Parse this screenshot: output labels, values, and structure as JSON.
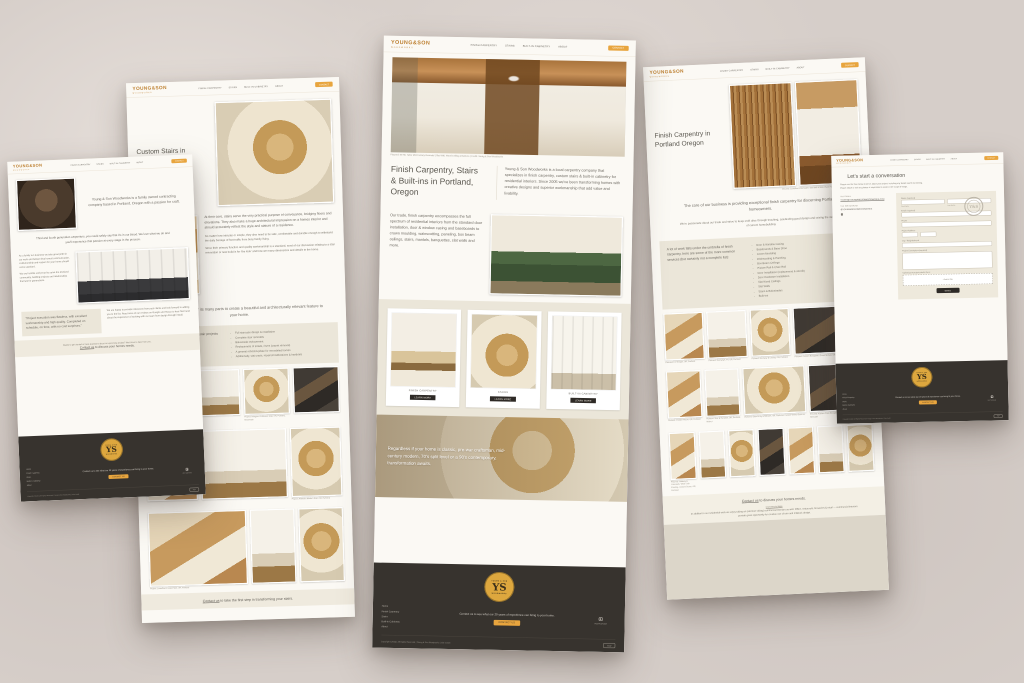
{
  "brand": {
    "logo_line1": "YOUNG&SON",
    "logo_line2": "WOODWORKS",
    "badge_top": "YOUNG & SON",
    "badge_bottom": "WOODWORKS",
    "monogram": "YS",
    "accent_orange": "#e8a53e",
    "logo_gold": "#bd7f2f",
    "footer_charcoal": "#37332e",
    "badge_gold": "#dda73e"
  },
  "nav": {
    "items": [
      "FINISH CARPENTRY",
      "STAIRS",
      "BUILT-IN CABINETRY",
      "ABOUT"
    ],
    "contact_label": "CONTACT"
  },
  "footer": {
    "links": [
      "Home",
      "Finish Carpentry",
      "Stairs",
      "Built-in Cabinetry",
      "About"
    ],
    "tagline": "Contact us to see what our 20 years of experience can bring to your home.",
    "contact_button": "CONTACT US",
    "social_label": "INSTAGRAM",
    "copyright": "Copyright ©2024  |  All Rights Reserved  |  Young & Son Woodworks  |  Site Credit",
    "top_button": "TOP"
  },
  "page_home": {
    "hero_caption": "Pictured: SE Mt. Tabor Mid-Century Remodel  |  Slat Wall, Wood Ceiling & Built-ins  |  Credit: Young & Son Woodworks",
    "heading": "Finish Carpentry, Stairs & Built-ins in Portland, Oregon",
    "intro": "Young & Son Woodworks is a local carpentry company that specializes in finish carpentry, custom stairs & built-in cabinetry for residential interiors.  Since 2005 we've been transforming homes with creative designs and superior workmanship that add value and livability.",
    "trade": "Our trade, finish carpentry encompasses the full spectrum of residential interiors from the standard door installation, door & window casing and baseboards to crown moulding, wainscotting, paneling, box beam ceilings, stairs, mantels, banquettes, slat walls and more.",
    "cards": [
      {
        "label": "FINISH CARPENTRY",
        "button": "LEARN MORE"
      },
      {
        "label": "STAIRS",
        "button": "LEARN MORE"
      },
      {
        "label": "BUILT-IN CABINETRY",
        "button": "LEARN MORE"
      }
    ],
    "band_text": "Regardless if your home is classic, pre-war craftsman, mid-century modern, 70's split level or a 90's contemporary, transformation awaits."
  },
  "page_about": {
    "intro": "Young & Son Woodworks is a family owned contracting company based in Portland, Oregon with a passion for craft.",
    "legacy": "Third and fourth generation carpenters, you could safely say that it's in our blood.  We love what we do and you'll experience that passion at every stage in the process.",
    "values_1": "As a family run business we take great pride in our work and believe that honest communication, craftsmanship and respect for your home should come standard.",
    "values_2": "We are humble and proud to serve the Portland community, building projects and relationships that last for generations.",
    "quote": "“Project execution was flawless, with excellent workmanship and high quality. Completed on schedule, on time, with no cost surprises.”",
    "reviews": "We are happy to provide references from past clients and look forward to adding you to the list.  Read more of our reviews on Google and Houzz to hear first hand about the experience of working with our team from design through install.",
    "cta_small": "Ready to get started or have questions about an upcoming project?  We'd love to hear from you.",
    "cta_link": "Contact us",
    "cta_rest": "to discuss your homes needs."
  },
  "page_stairs": {
    "title": "Custom Stairs in Portland Oregon",
    "body": "At their core, stairs serve the very practical purpose of conveyance, bridging floors and elevations. They also make a huge architectural impression on a homes interior and should accurately reflect the style and stature of a residence.",
    "body_sm1": "No matter how intricate or simple, they also need to be safe, comfortable and durable enough to withstand the daily barrage of foot traffic from busy family living.",
    "body_sm2": "Since their primary function and quality workmanship is a standard, most of our discussion relating to a stair renovation or new build is for 'the look' and how we marry dimensions and details to the home.",
    "statement": "Stair design is the sum of its many parts to create a beautiful and architecturally relevant feature to your home.",
    "list_intro": "Here is a list of the most common stair projects we perform:",
    "list": [
      "Full staircase design & installation",
      "Complete stair remodels",
      "Balustrade replacement",
      "Replacement of treads, risers (carpet removal)",
      "A general refresh/update for remodeled homes",
      "Additionally, stair parts, repairs/modifications & handrails"
    ],
    "gallery1": [
      "Project: Grand Ave Remodel, OR, Portland",
      "",
      "Project: Irvington Craftsman Stair, OR, Portland, Balustrade",
      ""
    ],
    "gallery2": [
      "",
      "",
      "Project: Alameda Modern Stair, OR, Portland"
    ],
    "gallery3": [
      "Project: Laurelhurst Grand Stair, OR, Portland",
      "",
      ""
    ],
    "cta_link": "Contact us",
    "cta_rest": "to take the first step in transforming your stairs."
  },
  "page_finish": {
    "title": "Finish Carpentry in Portland Oregon",
    "hero_caption": "Pictured: Laurelhurst Remodel  |  Slat Wall & Wide Plank Flooring  |  Credit: Young & Son Woodworks",
    "core": "The core of our business is providing exceptional finish carpentry for discerning Portland homeowners.",
    "passion": "We're passionate about our trade and strive to keep craft alive through teaching, celebrating good design and raising the status quo of current homebuilding.",
    "services_intro": "A lot of work falls under the umbrella of finish carpentry, here are some of the more common services (but certainly not a complete list):",
    "services": [
      "Door & Window Casing",
      "Baseboards & Base Shoe",
      "Crown Moulding",
      "Wainscotting & Paneling",
      "Box Beam Ceilings",
      "Picture Rail & Chair Rail",
      "Door Installation (replacement & retrofit)",
      "Door Hardware Installation",
      "Slat Wood Ceilings",
      "Slat Walls",
      "Stairs & Balustrades",
      "Built-ins"
    ],
    "gallery1": [
      "Pictured: Fir Stringer, OR, Portland",
      "Pictured: Doorways, Fir, OR, Portland",
      "Pictured: Doorway & Casing, OR, Portland",
      "Pictured: Custom Banquette, Green Mohair, OR, Portland"
    ],
    "gallery2": [
      "Pictured: Powder Room, OR, Portland",
      "Pictured: Stair & Handrail, OR, Portland, Walnut",
      "Pictured: Slate Entry & Millwork, OR, Portland, Custom Walnut Built-ins",
      "Pictured: Kitchen Pass-through, White Oak, OR, Portland, Mid-Century Remodel"
    ],
    "gallery3": [
      "Pictured: Hallway & Casework, White Oak Flooring, Custom Doors, OR, Portland",
      "",
      "",
      "",
      "",
      "",
      ""
    ],
    "cta_link": "Contact us",
    "cta_rest": "to discuss your homes needs.",
    "note_title": "Commercial Note",
    "note": "In addition to our residential work we enjoy taking on (and love doing) commercial interiors as well.  Office, restaurant, breweries & retail — commercial interiors provide great opportunity for creative use of trim and millwork design."
  },
  "page_contact": {
    "heading": "Let's start a conversation",
    "sub1": "Please use the form below to tell us about your project, including any details worth mentioning.",
    "sub2": "Please attach or link any photos or inspiration to assist in the scope of things.",
    "via_email_label": "VIA EMAIL",
    "email": "YOUNG@YOUNGANDSONWOODWORKS.COM",
    "via_social_label": "VIA INSTAGRAM",
    "handle": "@YOUNGANDSONWOODWORKS",
    "form": {
      "name_label": "Name (required)",
      "first_label": "First Name",
      "last_label": "Last Name",
      "email_label": "Email (required)",
      "phone_label": "Phone",
      "address_label": "Project Address",
      "city_label": "City / Neighborhood",
      "desc_label": "Project Description (required)",
      "upload_label": "Upload your project photos here:",
      "add_file_label": "+ Add a File",
      "send_label": "SEND"
    }
  }
}
